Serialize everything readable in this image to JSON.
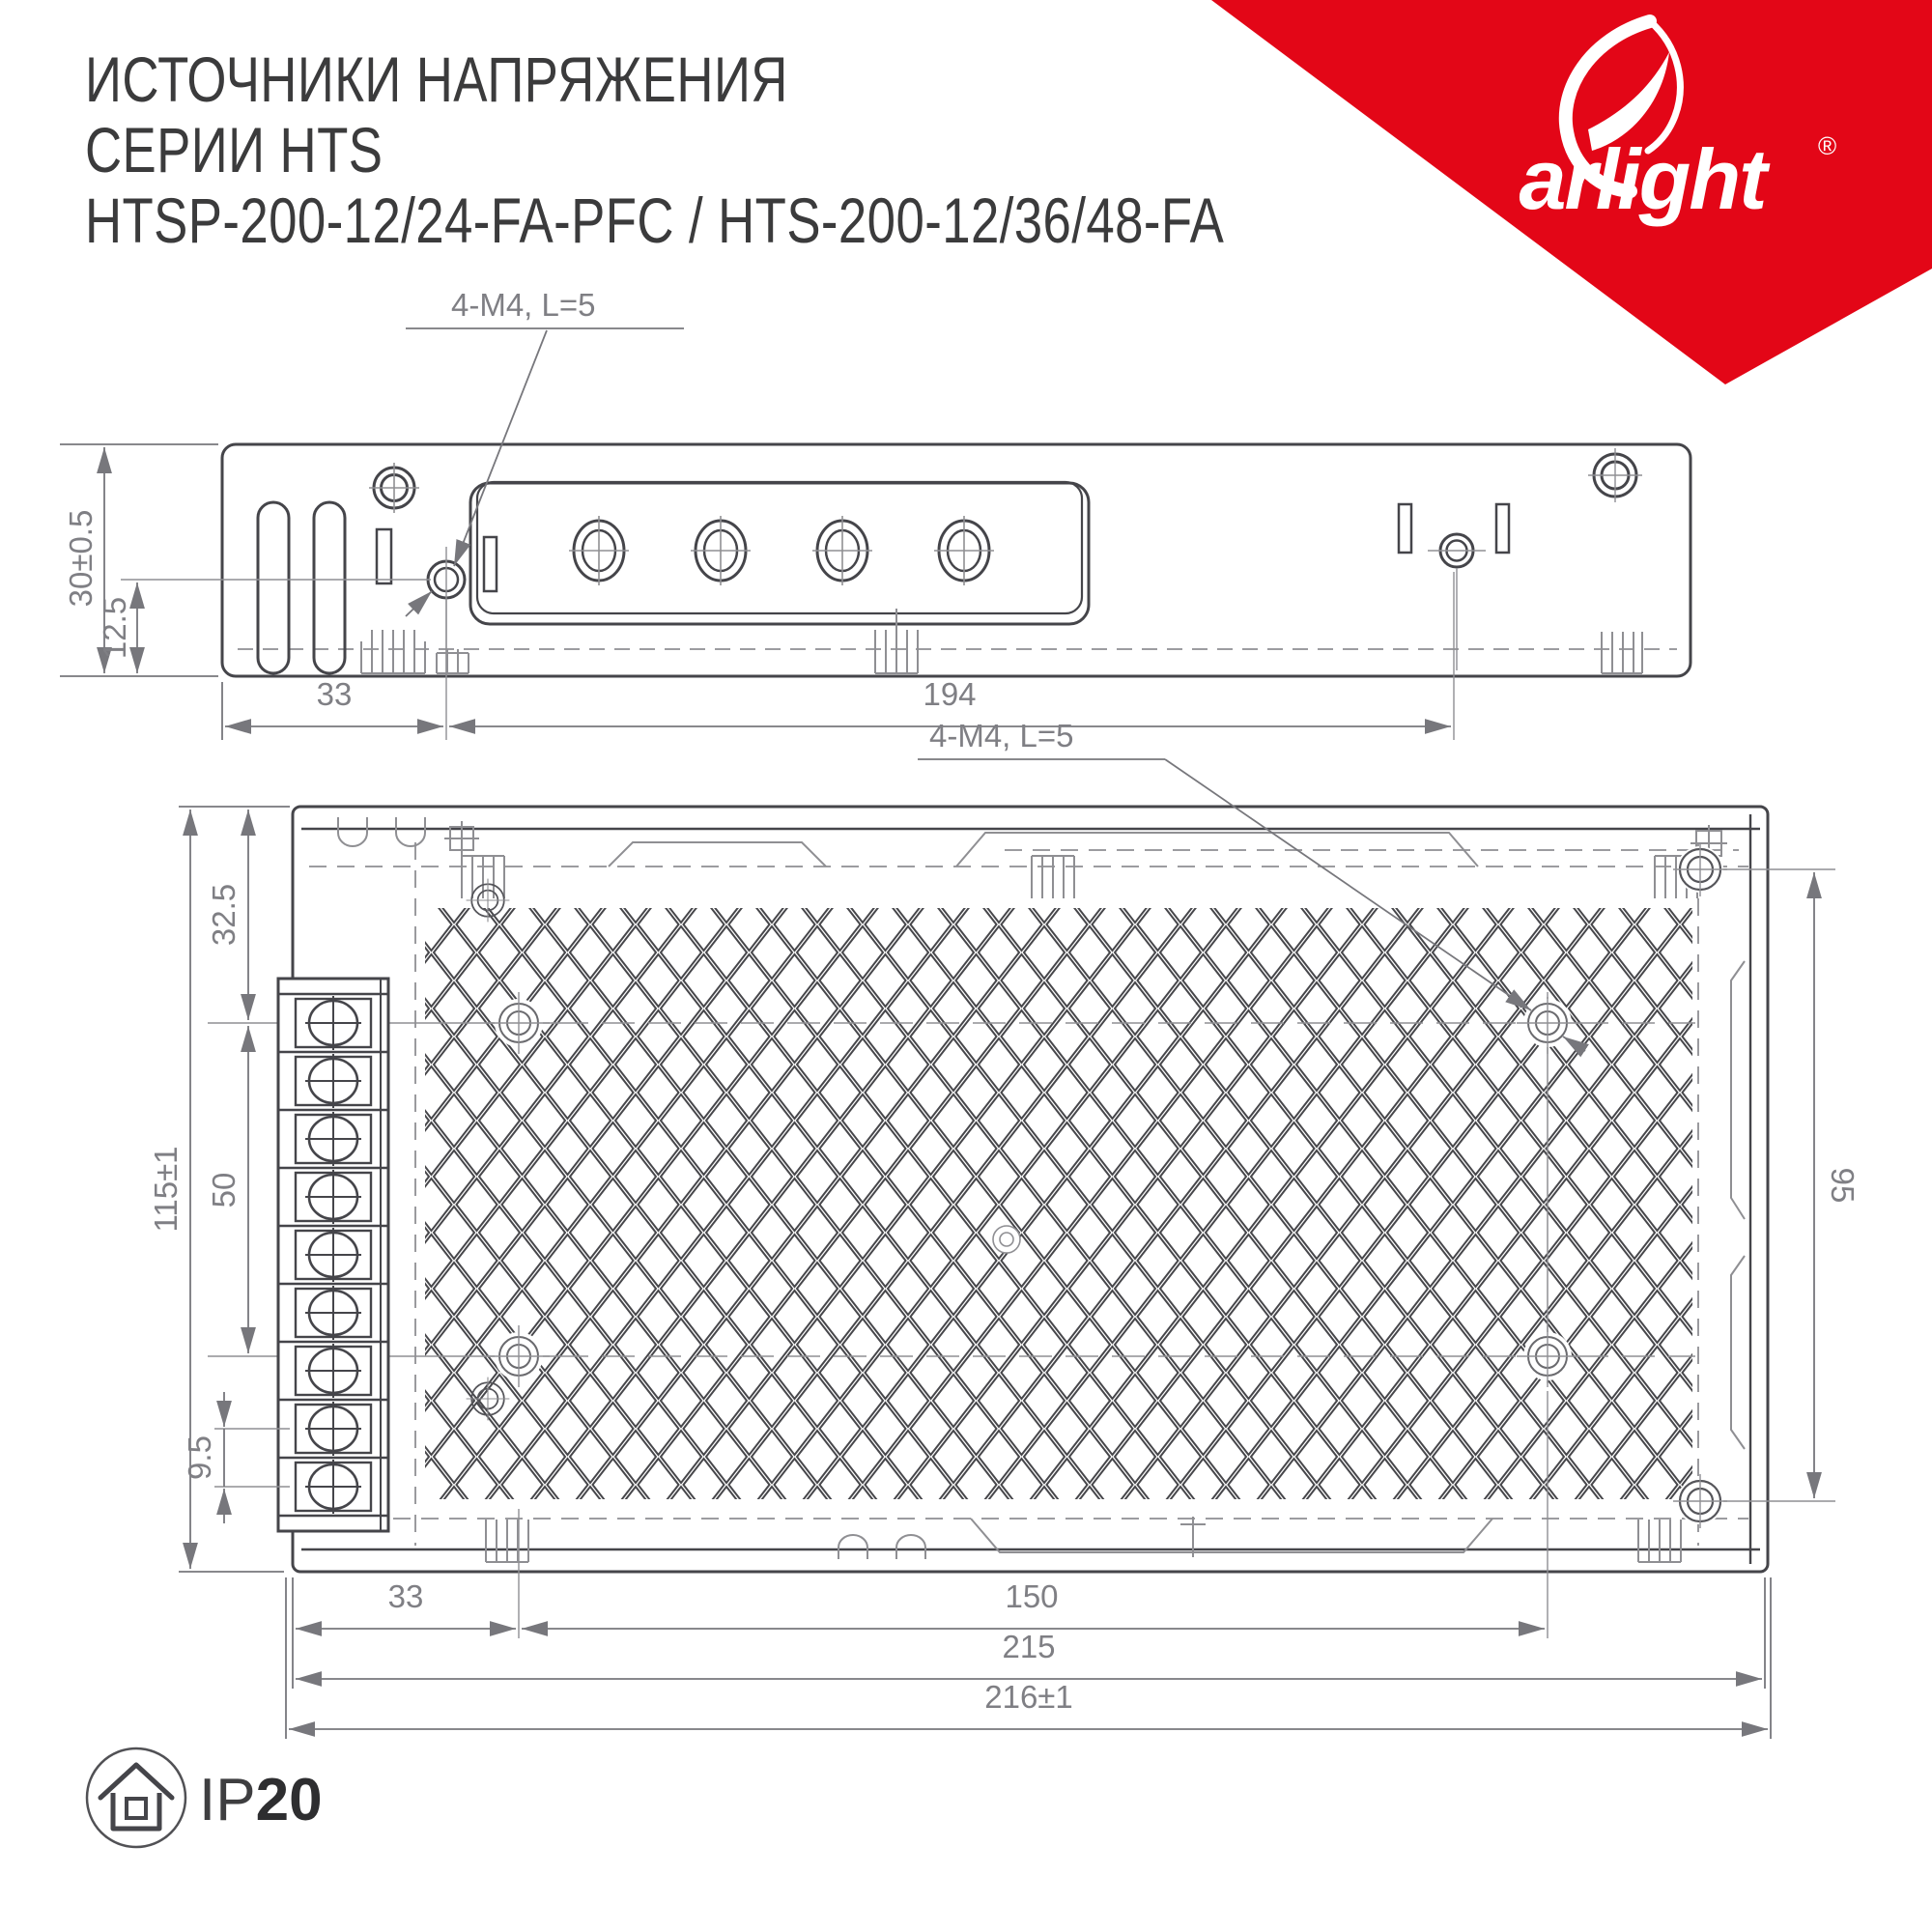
{
  "header": {
    "title_line1": "ИСТОЧНИКИ НАПРЯЖЕНИЯ",
    "title_line2": "СЕРИИ HTS",
    "title_line3": "HTSP-200-12/24-FA-PFC / HTS-200-12/36/48-FA"
  },
  "brand": {
    "name": "arlight",
    "registered": "®"
  },
  "side_view": {
    "label_screws": "4-M4, L=5",
    "dim_height": "30±0.5",
    "dim_screw_to_bottom": "12.5",
    "dim_edge_to_screw": "33",
    "dim_screw_span": "194"
  },
  "top_view": {
    "label_screws": "4-M4, L=5",
    "dim_top_to_row1": "32.5",
    "dim_height": "115±1",
    "dim_row_span": "50",
    "dim_terminal_pitch": "9.5",
    "dim_side_screw_span": "95",
    "dim_edge_to_col1": "33",
    "dim_col_span": "150",
    "dim_body_width": "215",
    "dim_total_width": "216±1"
  },
  "footer": {
    "ip_prefix": "IP",
    "ip_value": "20"
  },
  "colors": {
    "brand_red": "#e30617",
    "line_main": "#45454a",
    "line_aux": "#8f8f93",
    "dim_text": "#7f7f84",
    "title_text": "#3b3b3c"
  }
}
